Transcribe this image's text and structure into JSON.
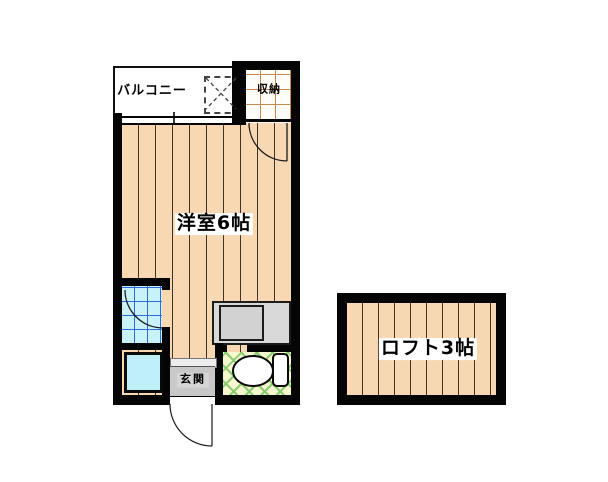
{
  "floorplan": {
    "rooms": {
      "balcony": "バルコニー",
      "closet": "収納",
      "main_room": "洋室6帖",
      "entrance": "玄関",
      "loft": "ロフト3帖"
    },
    "colors": {
      "flooring": "#f8d8b2",
      "bath_tile": "#c9f1f8",
      "bath_grid_line": "#2e6bd8",
      "sink": "#bff0f8",
      "toilet_floor": "#f5f8cf",
      "toilet_lattice": "#8ccb72",
      "entrance_floor": "#c8c8c8",
      "counter": "#d9d9d9",
      "closet_grid_line": "#c08a52",
      "wall": "#050505"
    }
  }
}
